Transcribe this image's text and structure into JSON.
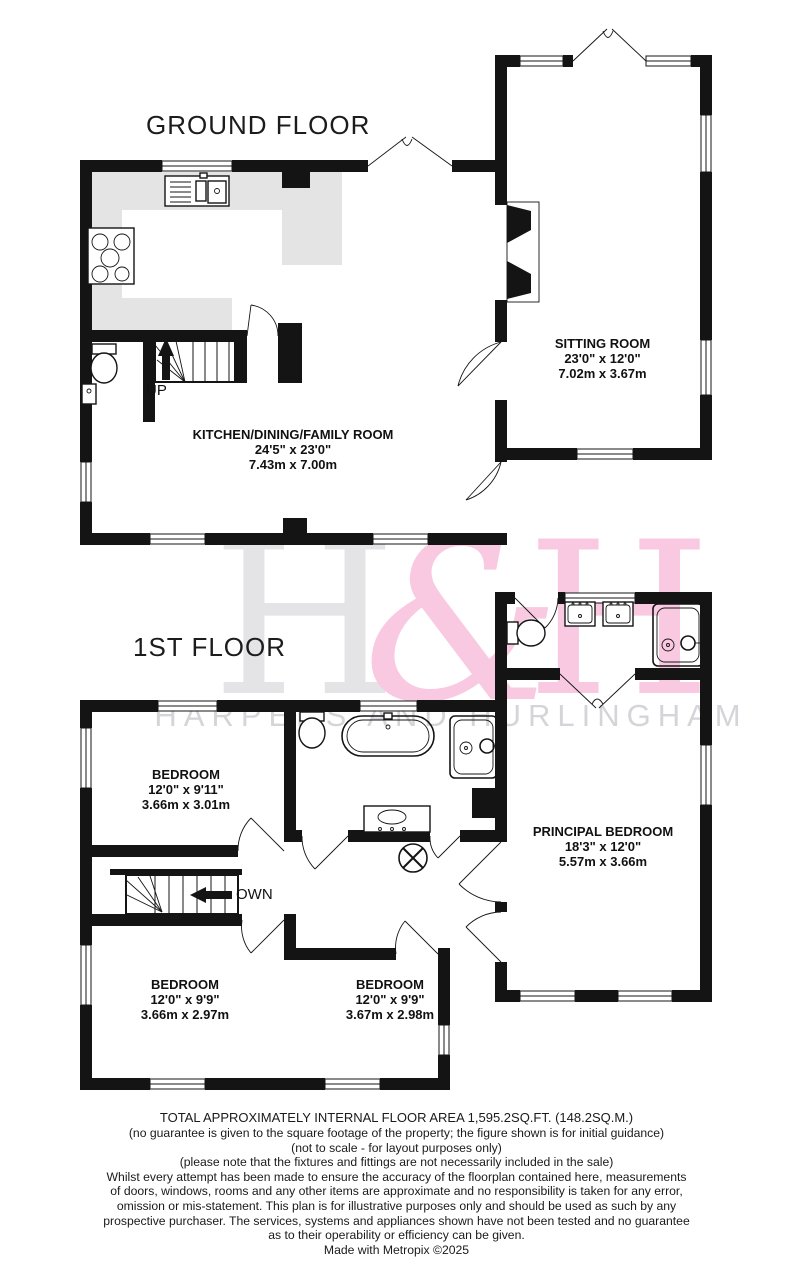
{
  "titles": {
    "ground": "GROUND FLOOR",
    "first": "1ST FLOOR"
  },
  "watermark": {
    "h1": "H",
    "amp": "&",
    "h2": "H",
    "name": "HARPERS AND HURLINGHAM",
    "pink": "#f8c9e0",
    "gray": "#e4e4e7"
  },
  "rooms": {
    "sitting": {
      "name": "SITTING ROOM",
      "imperial": "23'0\"  x 12'0\"",
      "metric": "7.02m  x 3.67m"
    },
    "kitchen": {
      "name": "KITCHEN/DINING/FAMILY ROOM",
      "imperial": "24'5\"  x 23'0\"",
      "metric": "7.43m  x 7.00m"
    },
    "bedroom1": {
      "name": "BEDROOM",
      "imperial": "12'0\"  x 9'11\"",
      "metric": "3.66m  x 3.01m"
    },
    "principal": {
      "name": "PRINCIPAL BEDROOM",
      "imperial": "18'3\"  x 12'0\"",
      "metric": "5.57m  x 3.66m"
    },
    "bedroom2": {
      "name": "BEDROOM",
      "imperial": "12'0\"  x 9'9\"",
      "metric": "3.66m  x 2.97m"
    },
    "bedroom3": {
      "name": "BEDROOM",
      "imperial": "12'0\"  x 9'9\"",
      "metric": "3.67m  x 2.98m"
    }
  },
  "stairs": {
    "up": "UP",
    "down": "OWN"
  },
  "footer": {
    "lines": [
      "TOTAL APPROXIMATELY INTERNAL FLOOR AREA 1,595.2SQ.FT. (148.2SQ.M.)",
      "(no guarantee is given to the square footage of the property; the figure shown is for initial guidance)",
      "(not to scale - for layout purposes only)",
      "(please note that the fixtures and fittings are not necessarily included in the sale)",
      "Whilst every attempt has been made to ensure the accuracy of the floorplan contained here, measurements",
      "of doors, windows, rooms and any other items are approximate and no responsibility is taken for any error,",
      "omission or mis-statement. This plan is for illustrative purposes only and should be used as such by any",
      "prospective purchaser. The services, systems and appliances shown have not been tested and no guarantee",
      "as to their operability or efficiency can be given.",
      "Made with Metropix ©2025"
    ]
  }
}
